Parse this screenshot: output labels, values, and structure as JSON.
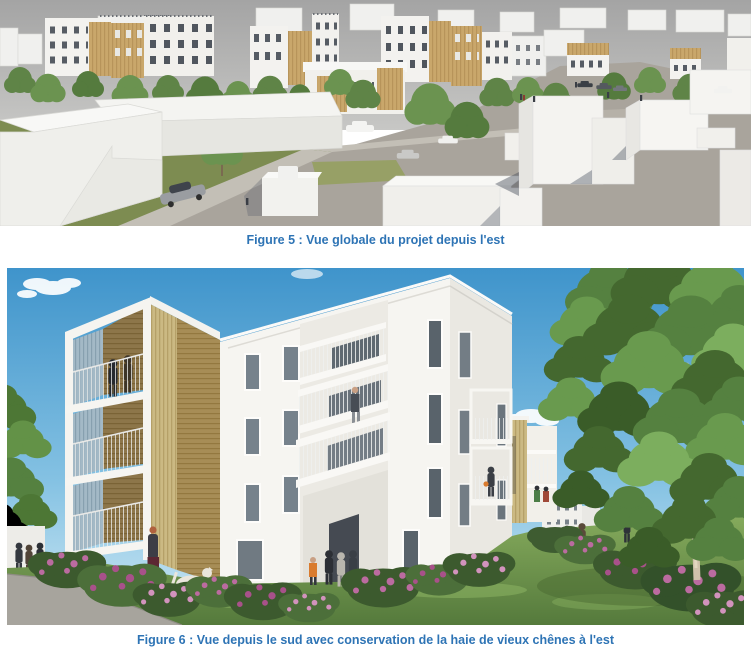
{
  "document": {
    "figures": [
      {
        "label": "Figure 5",
        "caption": "Figure 5 : Vue globale du projet depuis l'est",
        "alt": "Perspective aérienne grise : immeubles collectifs blancs et bois, arbres, voiries, volumes blancs au premier plan"
      },
      {
        "label": "Figure 6",
        "caption": "Figure 6 : Vue depuis le sud avec conservation de la haie de vieux chênes à l'est",
        "alt": "Perspective au sol : immeuble blanc de 4 étages avec tour de balcons en bois, pelouse, massifs fleuris, grand chêne à droite"
      }
    ],
    "caption_color": "#2E74B5"
  },
  "palette": {
    "page_bg": "#ffffff",
    "fig5_sky": "#ababab",
    "fig6_sky_top": "#3f94cb",
    "fig6_sky_bottom": "#cfe9f4",
    "facade_white": "#f5f4f0",
    "wood_tan": "#b59a5f",
    "tree_green": "#5d8046",
    "lawn_green": "#7d8c51",
    "flower_pink": "#bb6ba0",
    "pavement_gray": "#a9a49c"
  }
}
